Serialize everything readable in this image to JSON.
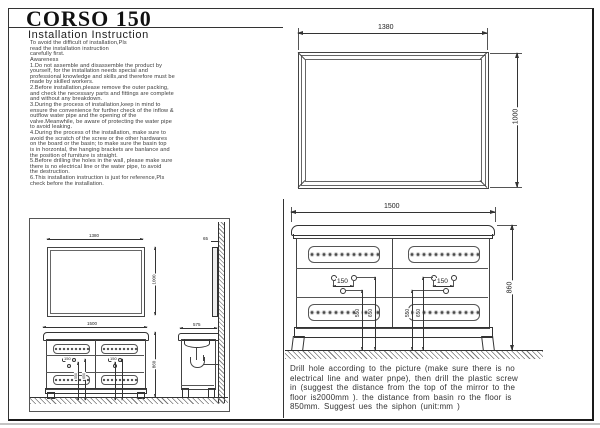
{
  "page": {
    "title": "CORSO 150",
    "subtitle": "Installation Instruction"
  },
  "instructions": {
    "lines": [
      "To avoid the difficult of installation,Pls",
      "read the installation instruction",
      "carefully first.",
      "Awareness",
      "1.Do not assemble and disassemble the product by",
      "yourself, for the installation needs special and",
      "professional knowledge and skills,and therefore must be",
      "made by skilled workers.",
      "2.Before installation,please remove the outer packing,",
      "and check the necessary parts and fittings are complete",
      "and without any breakdown.",
      "3.During the process of installation,keep in mind to",
      "ensure the convenience for further check of the inflow &",
      "outflow water pipe and the opening of the",
      "valve.Meanwhile, be aware of protecting the water pipe",
      "to avoid leaking.",
      "4.During the process of the installation, make sure to",
      "avoid the scratch of the screw or the other hardwares",
      "on the board or the basin; to make sure the basin top",
      "is in horzontal, the hanging brackets are banlance and",
      "the position of furniture is straight.",
      "5.Before drilling the holes in the wall, please make sure",
      "there is no electrical line or the water pipe, to avoid",
      "the destruction.",
      "6.This installation instruction is just for reference,Pls",
      "check before the installation."
    ]
  },
  "note": {
    "lines": [
      "Drill hole according to the picture (make sure there is no",
      "electrical line and water pnpe), then drill the plastic screw",
      "in (suggest the distance from the top of the mirror to the",
      "floor is2000mm ). the distance from basin ro the floor is",
      "850mm. Suggest ues the siphon (unit:mm )"
    ]
  },
  "mirror_view": {
    "width": "1380",
    "height": "1000"
  },
  "cabinet_view": {
    "width": "1500",
    "height": "860",
    "hole_span_left": "150",
    "hole_span_right": "150",
    "left_dim_inner": "550",
    "left_dim_outer": "650",
    "right_dim_inner": "550",
    "right_dim_outer": "650"
  },
  "overview": {
    "mirror_width": "1380",
    "mirror_height": "1000",
    "cabinet_width": "1500",
    "cabinet_height": "860",
    "hole_span_left": "150",
    "hole_span_right": "150",
    "dim_inner": "550",
    "dim_outer": "650",
    "mirror_thickness": "65",
    "cabinet_depth": "575"
  }
}
